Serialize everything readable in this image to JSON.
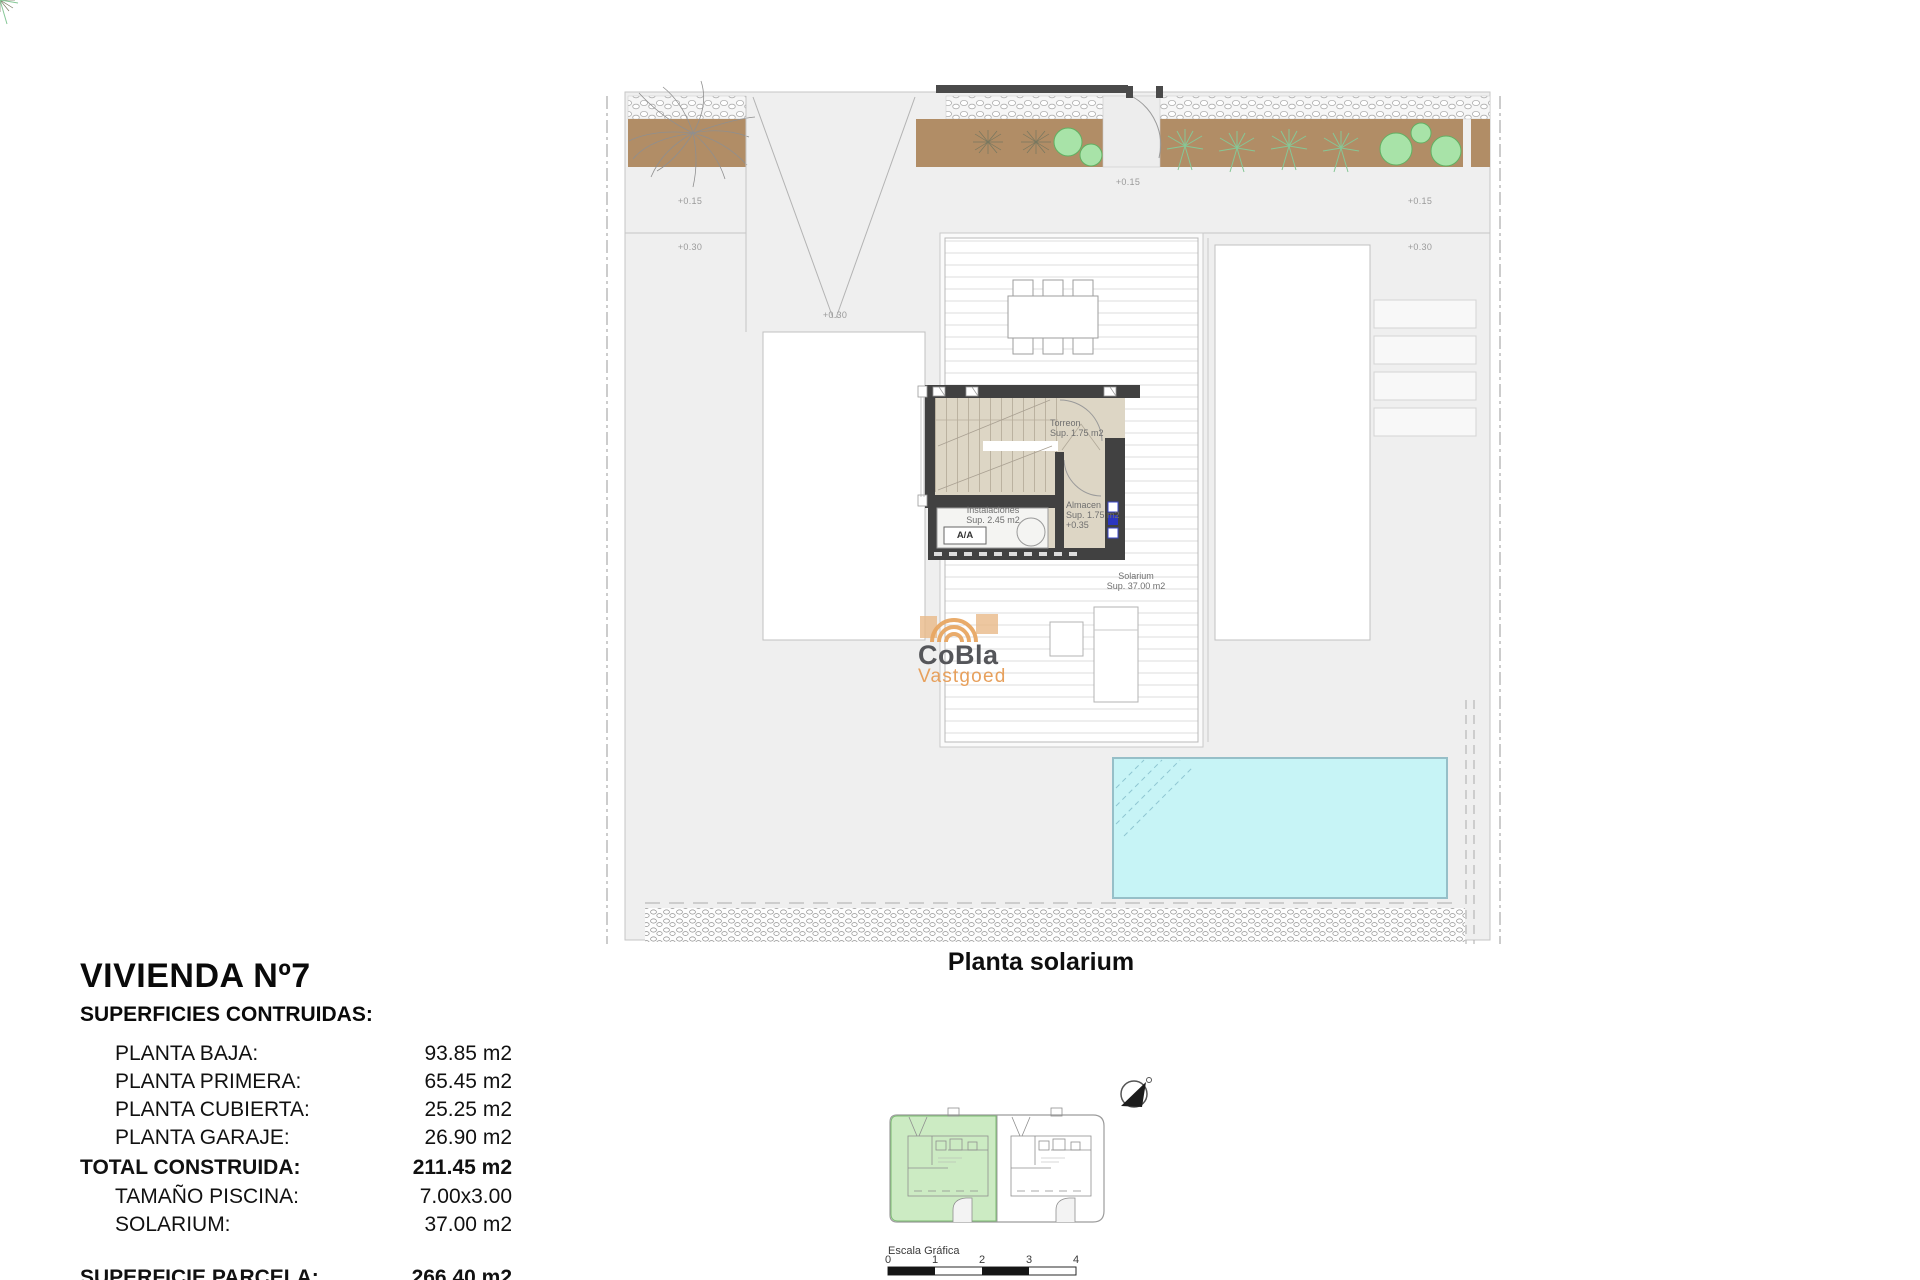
{
  "colors": {
    "parcel_gray": "#EFEFEF",
    "plant_brown": "#B18D66",
    "tree_green": "#A8E3A8",
    "wall_dark": "#414141",
    "stair_beige": "#DDD6C5",
    "pool_cyan": "#C7F4F6",
    "keyplan_green": "#BFE6B4",
    "logo_orange": "#E8A763",
    "logo_gray": "#55565A",
    "marker_blue": "#2B36C0"
  },
  "info_panel": {
    "title": "VIVIENDA Nº7",
    "subtitle": "SUPERFICIES CONTRUIDAS:",
    "rows": [
      {
        "label": "PLANTA BAJA:",
        "value": "93.85 m2"
      },
      {
        "label": "PLANTA PRIMERA:",
        "value": "65.45 m2"
      },
      {
        "label": "PLANTA CUBIERTA:",
        "value": "25.25 m2"
      },
      {
        "label": "PLANTA GARAJE:",
        "value": "26.90 m2"
      }
    ],
    "total_row": {
      "label": "TOTAL CONSTRUIDA:",
      "value": "211.45 m2"
    },
    "detail_rows": [
      {
        "label": "TAMAÑO PISCINA:",
        "value": "7.00x3.00"
      },
      {
        "label": "SOLARIUM:",
        "value": "37.00 m2"
      }
    ],
    "parcel_row": {
      "label": "SUPERFICIE PARCELA:",
      "value": "266.40 m2"
    }
  },
  "plan": {
    "caption": "Planta solarium",
    "rooms": {
      "torreon": {
        "name": "Torreon",
        "area": "Sup. 1.75 m2"
      },
      "almacen": {
        "name": "Almacen",
        "area": "Sup. 1.75 m2",
        "level": "+0.35"
      },
      "instalaciones": {
        "name": "Instalaciones",
        "area": "Sup. 2.45 m2"
      },
      "solarium": {
        "name": "Solarium",
        "area": "Sup. 37.00 m2"
      },
      "ac_unit": "A/A"
    },
    "level_marks": [
      {
        "text": "+0.15"
      },
      {
        "text": "+0.30"
      },
      {
        "text": "+0.30"
      },
      {
        "text": "+0.15"
      },
      {
        "text": "+0.15"
      },
      {
        "text": "+0.30"
      }
    ]
  },
  "logo": {
    "name": "CoBla",
    "tagline": "Vastgoed"
  },
  "scale_bar": {
    "label": "Escala Gráfica",
    "ticks": [
      "0",
      "1",
      "2",
      "3",
      "4"
    ]
  }
}
